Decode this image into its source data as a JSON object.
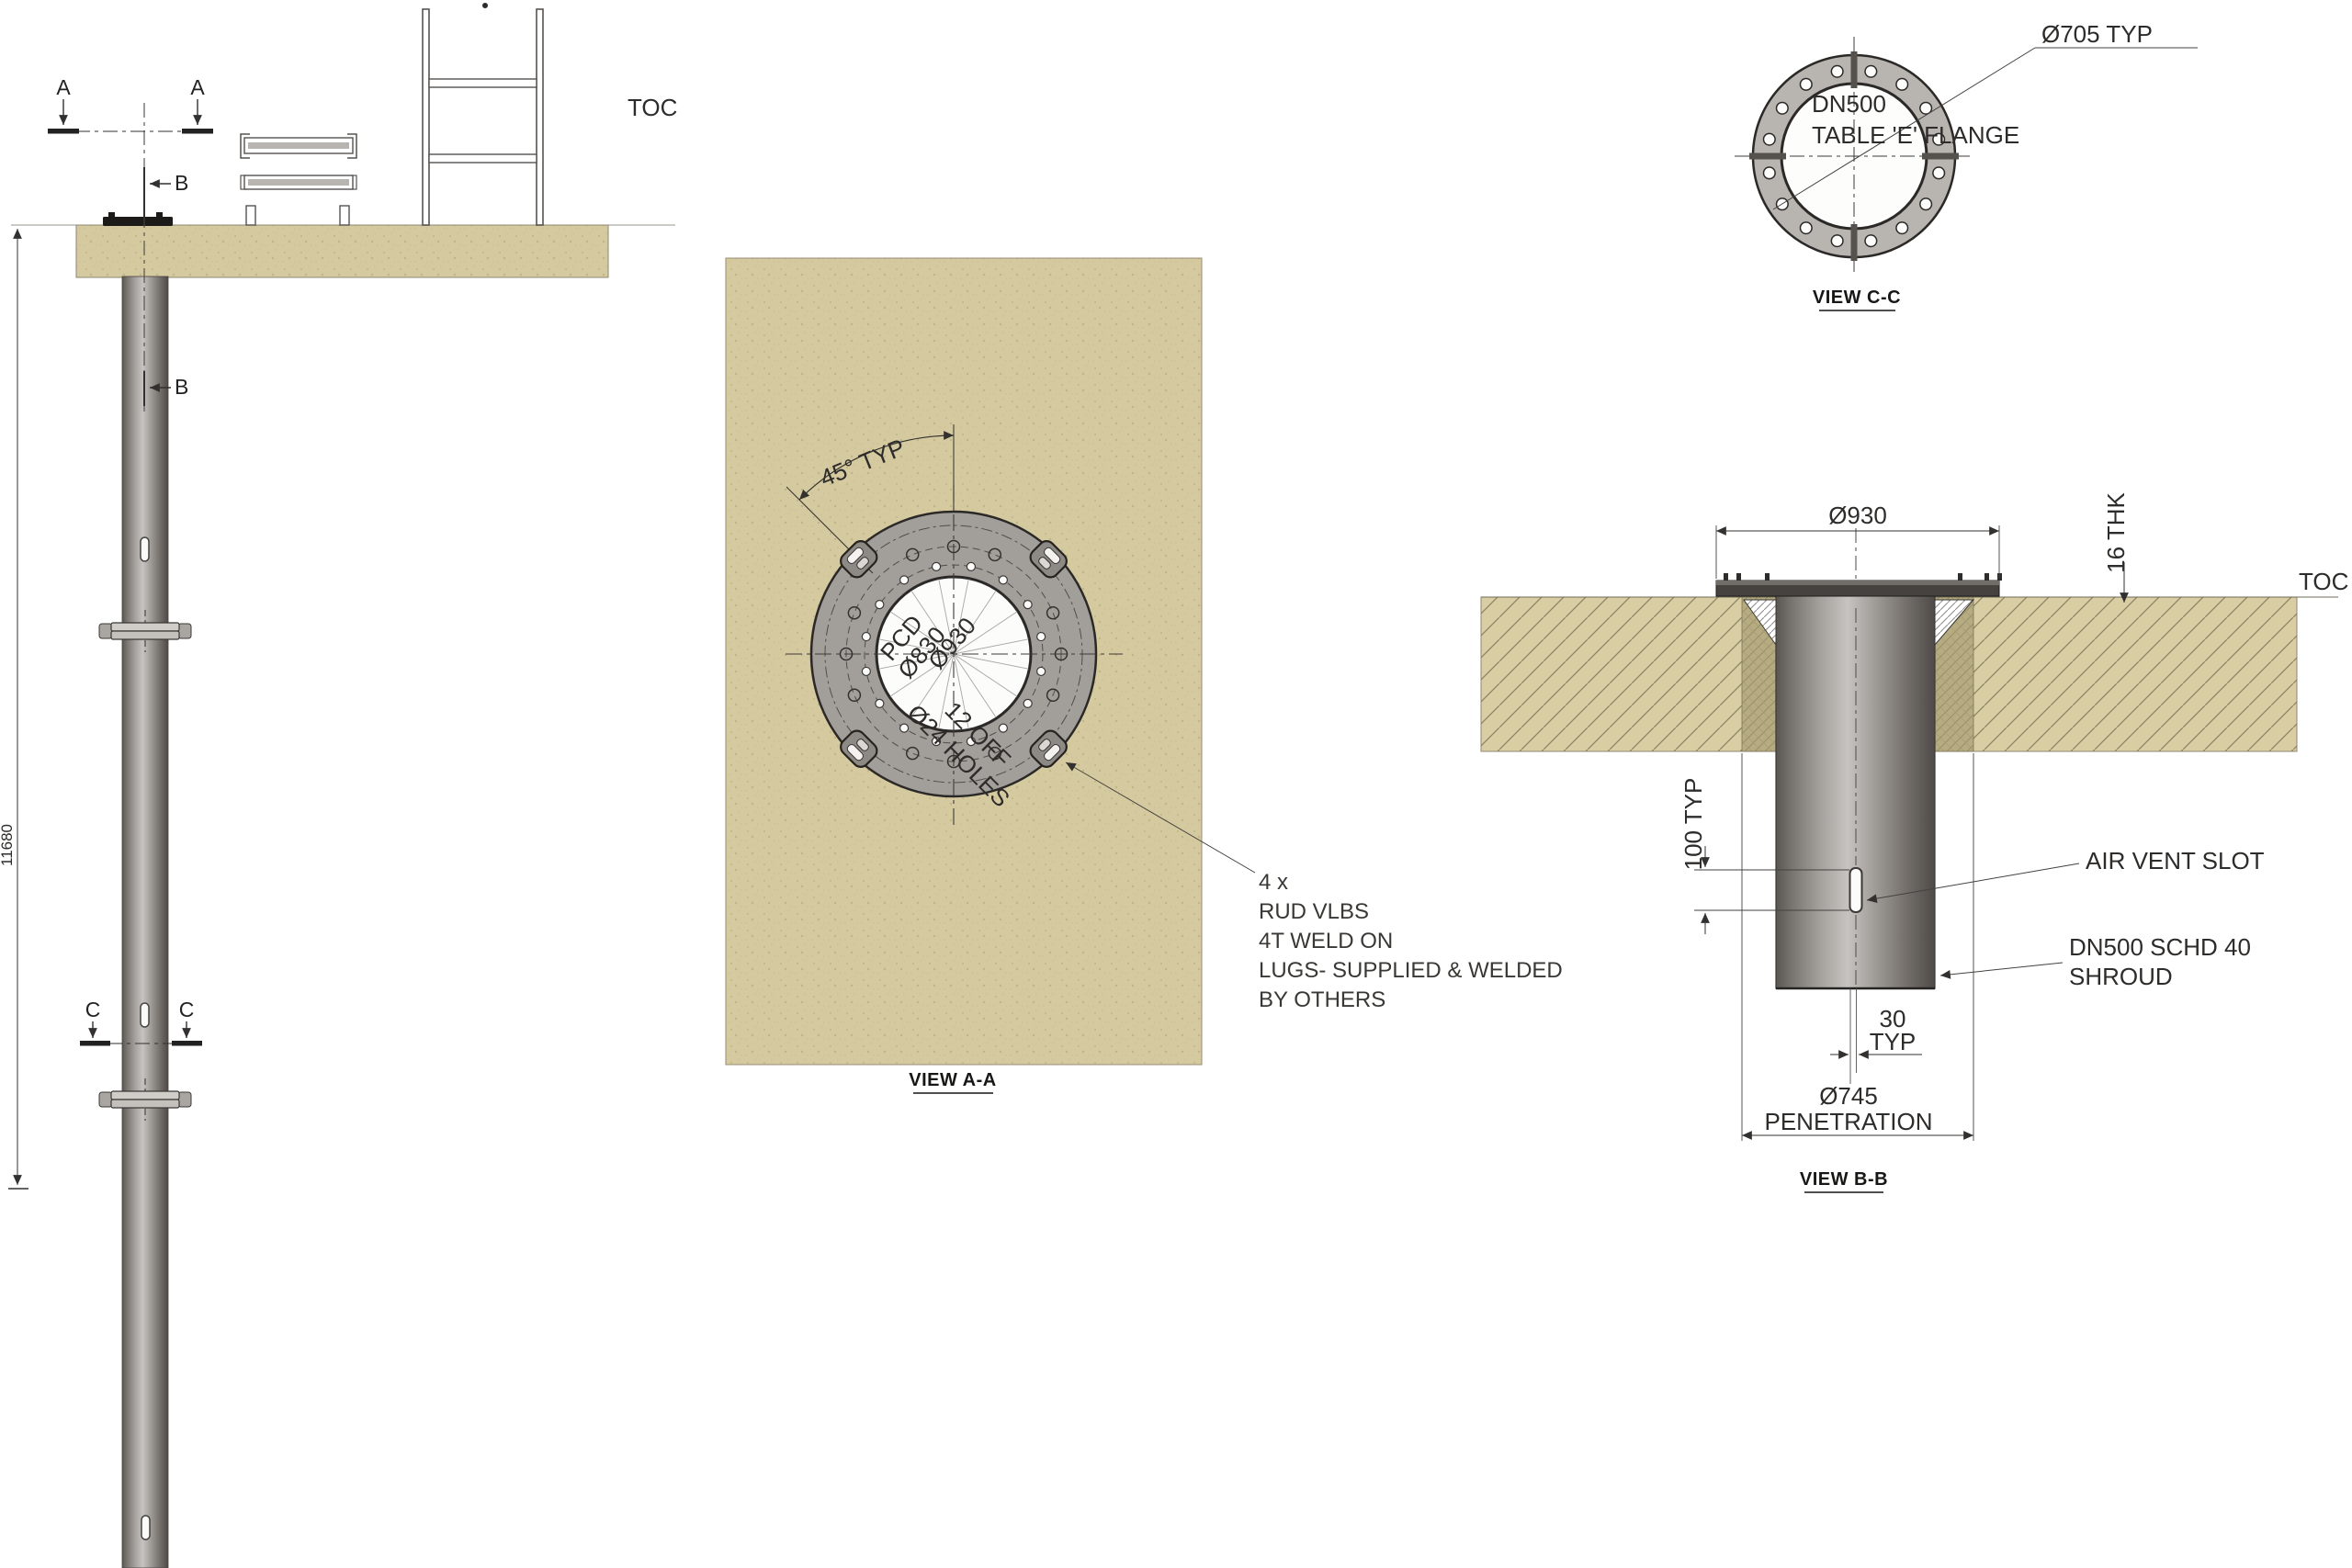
{
  "left_view": {
    "toc": "TOC",
    "a": "A",
    "b": "B",
    "c": "C",
    "height": "11680"
  },
  "view_aa": {
    "angle": "45° TYP",
    "pcd": "PCD",
    "pcd_dia": "Ø830",
    "od": "Ø930",
    "holes1": "12 OFF",
    "holes2": "Ø24 HOLES",
    "note": [
      "4 x",
      "RUD VLBS",
      "4T WELD ON",
      "LUGS- SUPPLIED & WELDED",
      "BY OTHERS"
    ],
    "caption": "VIEW A-A",
    "outer_hole_count": 12,
    "inner_hole_count": 16,
    "lug_count": 4
  },
  "view_cc": {
    "dia": "Ø705 TYP",
    "l1": "DN500",
    "l2": "TABLE 'E' FLANGE",
    "caption": "VIEW C-C",
    "hole_count": 16
  },
  "view_bb": {
    "dia": "Ø930",
    "thk": "16 THK",
    "toc": "TOC",
    "slot_dim": "100 TYP",
    "slot": "AIR VENT SLOT",
    "shroud1": "DN500 SCHD 40",
    "shroud2": "SHROUD",
    "gap1": "30",
    "gap2": "TYP",
    "pen1": "Ø745",
    "pen2": "PENETRATION",
    "caption": "VIEW B-B"
  },
  "colors": {
    "concrete": "#d5ca9f",
    "concrete_dark": "#b6ab81",
    "steel": "#a29e9a",
    "line": "#2e2c2a"
  }
}
